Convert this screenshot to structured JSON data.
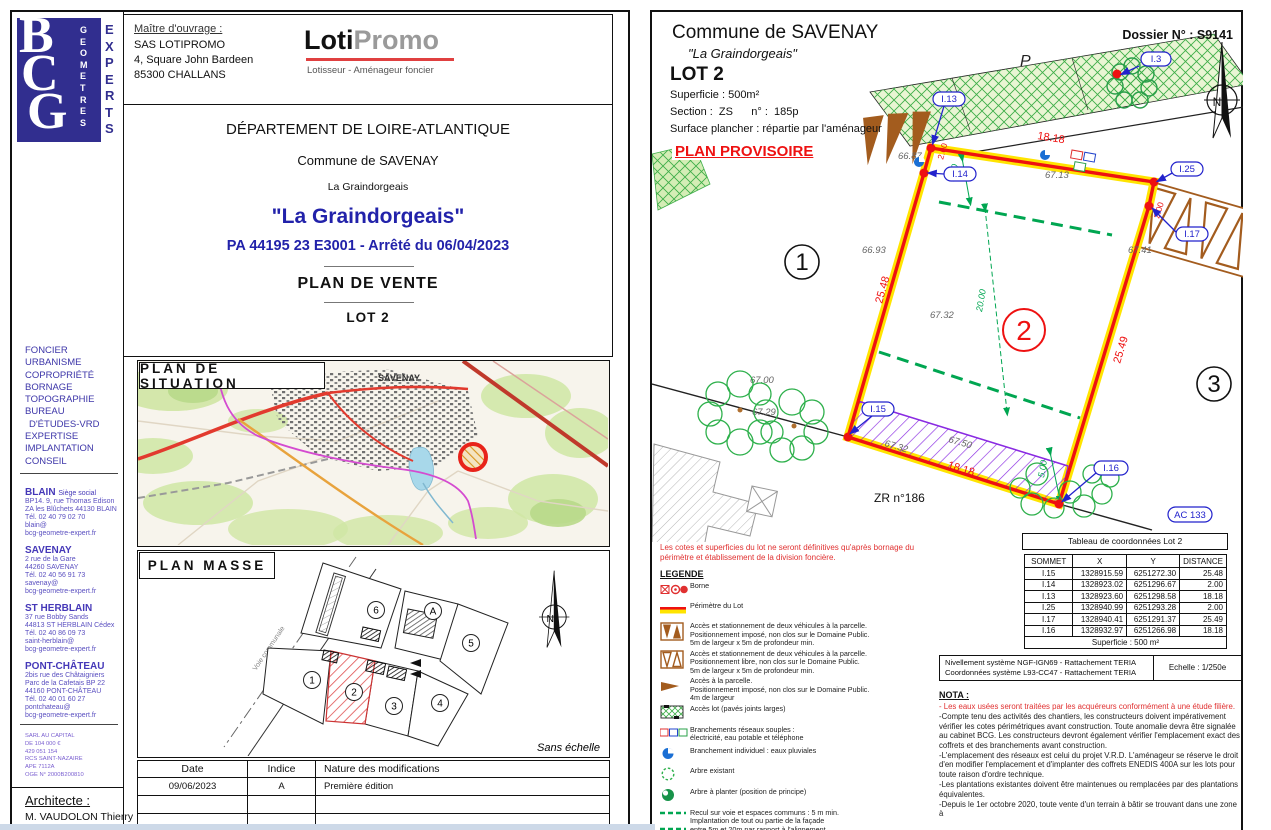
{
  "doc": {
    "logo": {
      "b": "B",
      "c": "C",
      "g": "G",
      "geometres": "GEOMETRES",
      "experts": "EXPERTS"
    },
    "services": [
      "FONCIER",
      "URBANISME",
      "COPROPRIÉTÉ",
      "BORNAGE",
      "TOPOGRAPHIE",
      "BUREAU",
      "D'ÉTUDES-VRD",
      "EXPERTISE",
      "IMPLANTATION",
      "CONSEIL"
    ],
    "offices": [
      {
        "name": "BLAIN",
        "tag": "Siège social",
        "lines": [
          "BP14. 9, rue Thomas Edison",
          "ZA les Blûchets 44130 BLAIN",
          "Tél. 02 40 79 02 70",
          "blain@",
          "bcg-geometre-expert.fr"
        ]
      },
      {
        "name": "SAVENAY",
        "tag": "",
        "lines": [
          "2 rue de la Gare",
          "44260 SAVENAY",
          "Tél. 02 40 56 91 73",
          "savenay@",
          "bcg-geometre-expert.fr"
        ]
      },
      {
        "name": "ST HERBLAIN",
        "tag": "",
        "lines": [
          "37 rue Bobby Sands",
          "44813 ST HERBLAIN Cédex",
          "Tél. 02 40 86 09 73",
          "saint-herblain@",
          "bcg-geometre-expert.fr"
        ]
      },
      {
        "name": "PONT-CHÂTEAU",
        "tag": "",
        "lines": [
          "2bis rue des Châtaigniers",
          "Parc de la Cafetais BP 22",
          "44160 PONT-CHÂTEAU",
          "Tél. 02 40 01 60 27",
          "pontchateau@",
          "bcg-geometre-expert.fr"
        ]
      }
    ],
    "legal": [
      "SARL AU CAPITAL",
      "DE 104 000 €",
      "429 051 154",
      "RCS SAINT-NAZAIRE",
      "APE 7112A",
      "OGE N° 2000B200810"
    ],
    "architect": {
      "label": "Architecte :",
      "name": "M. VAUDOLON Thierry",
      "addr": "53. Kercouret"
    },
    "owner": {
      "label": "Maître d'ouvrage :",
      "l1": "SAS LOTIPROMO",
      "l2": "4, Square John Bardeen",
      "l3": "85300 CHALLANS"
    },
    "brand": {
      "p1": "Loti",
      "p2": "Promo",
      "tagline": "Lotisseur - Aménageur foncier"
    },
    "titles": {
      "dept": "DÉPARTEMENT DE LOIRE-ATLANTIQUE",
      "commune": "Commune de SAVENAY",
      "place": "La Graindorgeais",
      "quoted": "\"La Graindorgeais\"",
      "pa": "PA 44195 23 E3001 - Arrêté du 06/04/2023",
      "doc": "PLAN  DE  VENTE",
      "lot": "LOT 2"
    },
    "situation": {
      "title": "PLAN  DE  SITUATION",
      "city": "SAVENAY"
    },
    "masse": {
      "title": "PLAN  MASSE",
      "scale": "Sans échelle",
      "road": "Voie communale",
      "north": "N",
      "lots": [
        "1",
        "2",
        "3",
        "4",
        "5",
        "6",
        "A"
      ]
    },
    "mods": {
      "h1": "Date",
      "h2": "Indice",
      "h3": "Nature des modifications",
      "r1c1": "09/06/2023",
      "r1c2": "A",
      "r1c3": "Première édition"
    }
  },
  "plan": {
    "header": {
      "commune": "Commune de SAVENAY",
      "place": "\"La Graindorgeais\"",
      "lot": "LOT 2",
      "superficie": "Superficie :  500m²",
      "section": "Section :  ZS      n° :  185p",
      "surface_plancher": "Surface plancher : répartie par l'aménageur",
      "provisoire": "PLAN PROVISOIRE",
      "dossier": "Dossier N° : S9141"
    },
    "drawing": {
      "dim_top": "18.18",
      "dim_left": "25.48",
      "dim_right": "25.49",
      "dim_bottom": "18.18",
      "dim_short_left": "2.00",
      "dim_short_right": "2.00",
      "dim_recul_top": "5.00",
      "dim_depth": "20.00",
      "dim_recul_bottom": "5.00",
      "levels": [
        "66.87",
        "66.93",
        "67.13",
        "67.32",
        "67.41",
        "67.00",
        "67.29",
        "67.32",
        "67.50",
        "67.78"
      ],
      "markers": [
        "I.3",
        "I.13",
        "I.14",
        "I.25",
        "I.17",
        "I.15",
        "I.16"
      ],
      "parcel_ref": "AC 133",
      "zone_ref": "ZR n°186",
      "p_zone": "P",
      "north": "N",
      "lots": [
        "1",
        "2",
        "3"
      ]
    },
    "disclaimer": "Les cotes et superficies du lot ne seront définitives qu'après bornage du périmètre et établissement de la division foncière.",
    "legend": {
      "title": "LEGENDE",
      "items": [
        {
          "l1": "Borne",
          "l2": "",
          "l3": ""
        },
        {
          "l1": "Périmètre du Lot",
          "l2": "",
          "l3": ""
        },
        {
          "l1": "Accès et stationnement de deux véhicules à la parcelle.",
          "l2": "Positionnement imposé, non clos sur le Domaine Public.",
          "l3": "5m de largeur x 5m de profondeur min."
        },
        {
          "l1": "Accès et stationnement de deux véhicules à la parcelle.",
          "l2": "Positionnement libre, non clos sur le Domaine Public.",
          "l3": "5m de largeur x 5m de profondeur min."
        },
        {
          "l1": "Accès à la parcelle.",
          "l2": "Positionnement imposé, non clos sur le Domaine Public.",
          "l3": "4m de largeur"
        },
        {
          "l1": "Accès lot (pavés joints larges)",
          "l2": "",
          "l3": ""
        },
        {
          "l1": "Branchements réseaux souples :",
          "l2": "électricité, eau potable et téléphone",
          "l3": ""
        },
        {
          "l1": "Branchement individuel : eaux pluviales",
          "l2": "",
          "l3": ""
        },
        {
          "l1": "Arbre existant",
          "l2": "",
          "l3": ""
        },
        {
          "l1": "Arbre à planter (position de principe)",
          "l2": "",
          "l3": ""
        },
        {
          "l1": "Recul sur voie et espaces communs : 5 m min.",
          "l2": "Implantation de tout ou partie de la façade",
          "l3": "entre 5m et 20m par rapport à l'alignement"
        },
        {
          "l1": "Zone non-aédificandi pour la préservation",
          "l2": "des haies existantes (3m d'emprise)",
          "l3": ""
        }
      ]
    },
    "coords": {
      "title": "Tableau de coordonnées Lot 2",
      "headers": [
        "SOMMET",
        "X",
        "Y",
        "DISTANCE"
      ],
      "rows": [
        [
          "I.15",
          "1328915.59",
          "6251272.30",
          "25.48"
        ],
        [
          "I.14",
          "1328923.02",
          "6251296.67",
          "2.00"
        ],
        [
          "I.13",
          "1328923.60",
          "6251298.58",
          "18.18"
        ],
        [
          "I.25",
          "1328940.99",
          "6251293.28",
          "2.00"
        ],
        [
          "I.17",
          "1328940.41",
          "6251291.37",
          "25.49"
        ],
        [
          "I.16",
          "1328932.97",
          "6251266.98",
          "18.18"
        ]
      ],
      "footer": "Superficie : 500 m²"
    },
    "georef": {
      "line1": "Nivellement système NGF-IGN69 - Rattachement TERIA",
      "line2": "Coordonnées système L93-CC47  - Rattachement TERIA",
      "scale": "Echelle : 1/250e"
    },
    "nota": {
      "title": "NOTA :",
      "lines": [
        "- Les eaux usées seront traitées par les acquéreurs conformément à une étude filière.",
        "-Compte tenu des activités des chantiers, les constructeurs doivent impérativement vérifier les cotes périmétriques avant construction. Toute anomalie devra être signalée au cabinet BCG. Les constructeurs devront également vérifier l'emplacement exact des coffrets et des branchements avant construction.",
        "-L'emplacement des réseaux est celui du projet V.R.D. L'aménageur se réserve le droit d'en modifier l'emplacement et d'implanter des coffrets ENEDIS 400A sur les lots pour toute raison d'ordre technique.",
        "-Les plantations existantes doivent être maintenues ou remplacées par des plantations équivalentes.",
        "-Depuis le 1er octobre 2020, toute vente d'un terrain à bâtir se trouvant dans une zone à"
      ]
    }
  }
}
